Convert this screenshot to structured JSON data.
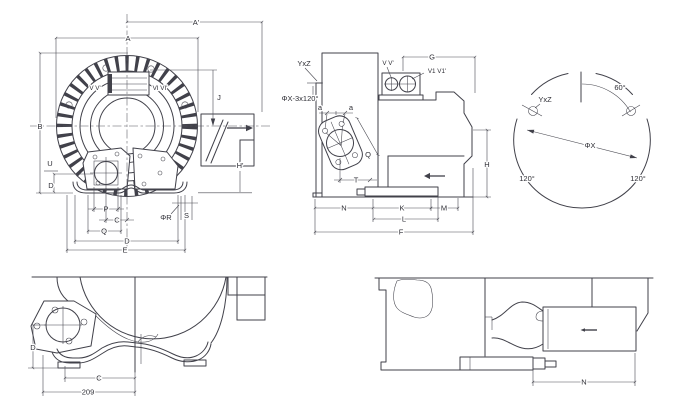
{
  "page": {
    "background": "#ffffff",
    "line_color": "#41414a"
  },
  "views": {
    "front": {
      "title": "front view",
      "dims": {
        "a_prime": "A'",
        "a": "A",
        "b": "B",
        "j": "J",
        "h_prime": "H'",
        "u": "U",
        "d_left": "D",
        "p": "P",
        "c": "C",
        "q": "Q",
        "d_bottom": "D",
        "e": "E",
        "phi_r": "ΦR",
        "s": "S",
        "v": "V V'",
        "vi": "VI VI'"
      }
    },
    "side": {
      "title": "side view",
      "dims": {
        "yxz": "YxZ",
        "phix_note": "ΦX-3x120°",
        "v": "V V'",
        "v1": "V1 V1'",
        "g": "G",
        "a_left": "a",
        "a_right": "a",
        "q": "Q",
        "t": "T",
        "n": "N",
        "k": "K",
        "l": "L",
        "m": "M",
        "f": "F",
        "h": "H"
      }
    },
    "bolt_circle": {
      "title": "flange bolt circle",
      "dims": {
        "deg60": "60°",
        "yxz": "YxZ",
        "phix": "ΦX",
        "deg120_left": "120°",
        "deg120_right": "120°"
      }
    },
    "bottom_left": {
      "title": "bottom section view left",
      "dims": {
        "d": "D",
        "c": "C",
        "base_209": "209"
      }
    },
    "bottom_right": {
      "title": "bottom section view right",
      "dims": {
        "n": "N"
      }
    }
  }
}
